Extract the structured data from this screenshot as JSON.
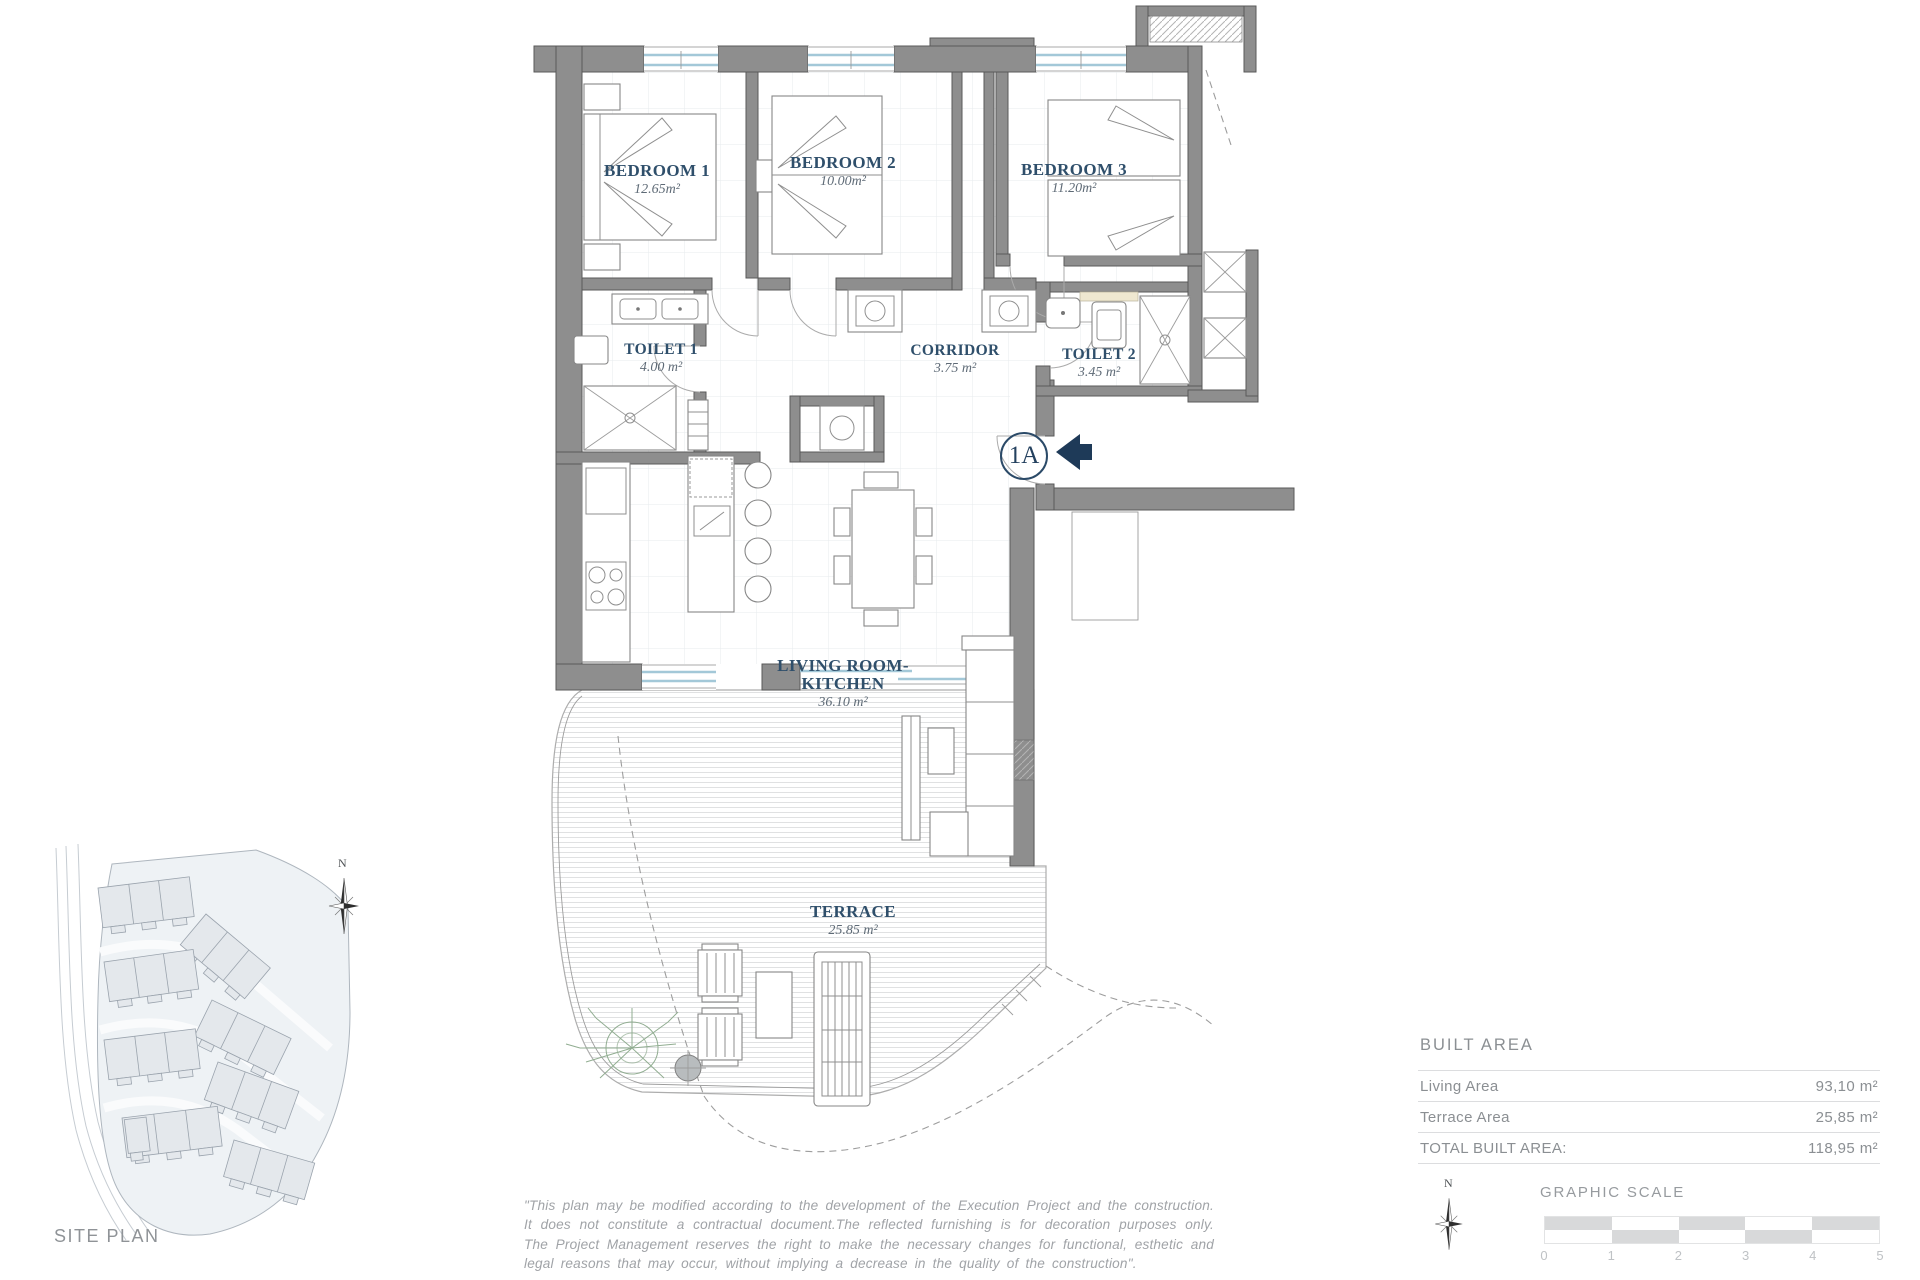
{
  "plan": {
    "unit_badge": "1A",
    "rooms": {
      "bedroom1": {
        "label": "BEDROOM 1",
        "area": "12.65m²"
      },
      "bedroom2": {
        "label": "BEDROOM 2",
        "area": "10.00m²"
      },
      "bedroom3": {
        "label": "BEDROOM 3",
        "area": "11.20m²"
      },
      "toilet1": {
        "label": "TOILET 1",
        "area": "4.00 m²"
      },
      "corridor": {
        "label": "CORRIDOR",
        "area": "3.75 m²"
      },
      "toilet2": {
        "label": "TOILET 2",
        "area": "3.45 m²"
      },
      "living": {
        "label_line1": "LIVING ROOM-",
        "label_line2": "KITCHEN",
        "area": "36.10 m²"
      },
      "terrace": {
        "label": "TERRACE",
        "area": "25.85 m²"
      }
    }
  },
  "site_plan": {
    "label": "SITE PLAN",
    "compass": "N"
  },
  "built_area": {
    "title": "BUILT AREA",
    "rows": [
      {
        "label": "Living Area",
        "value": "93,10 m²"
      },
      {
        "label": "Terrace Area",
        "value": "25,85 m²"
      },
      {
        "label": "TOTAL BUILT AREA:",
        "value": "118,95 m²"
      }
    ]
  },
  "graphic_scale": {
    "title": "GRAPHIC SCALE",
    "compass": "N",
    "ticks": [
      "0",
      "1",
      "2",
      "3",
      "4",
      "5"
    ]
  },
  "disclaimer": "\"This plan may be modified according to the development of the Execution Project and the construction. It does not constitute a contractual document.The reflected furnishing is for decoration purposes only. The Project Management reserves the right to make the necessary changes for functional, esthetic and legal reasons that may occur, without implying a decrease in the quality of the construction\".",
  "colors": {
    "accent_navy": "#24415f",
    "wall_gray": "#8e8e8e",
    "window_blue": "#a3c8d8",
    "highlight_unit": "#5b6c9a",
    "muted_text": "#8b8f93"
  }
}
